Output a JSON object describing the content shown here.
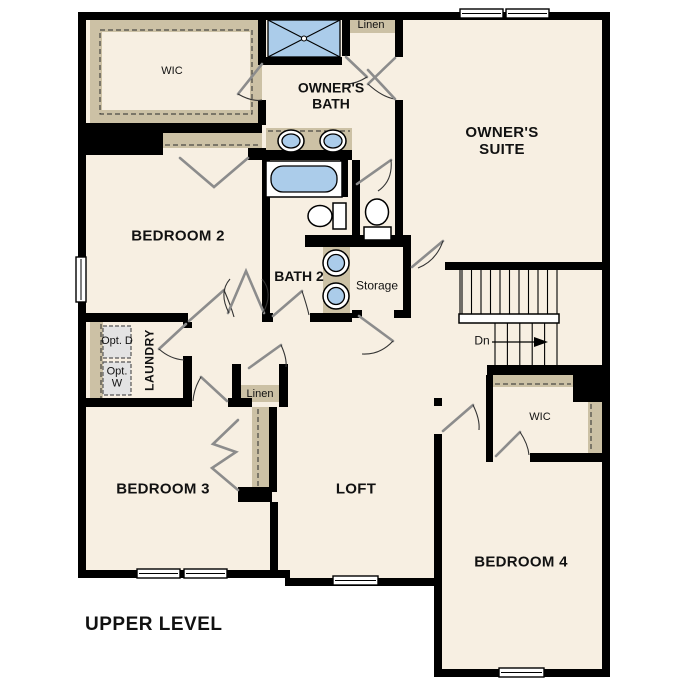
{
  "plan_title": "UPPER LEVEL",
  "labels": {
    "wic_owner": "WIC",
    "linen_owner": "Linen",
    "owners_bath": "OWNER'S BATH",
    "owners_suite": "OWNER'S SUITE",
    "bedroom2": "BEDROOM 2",
    "bath2": "BATH 2",
    "storage": "Storage",
    "stairs_dn": "Dn",
    "laundry": "LAUNDRY",
    "opt_dryer": "Opt. D",
    "opt_washer": "Opt. W",
    "linen_hall": "Linen",
    "bedroom3": "BEDROOM 3",
    "loft": "LOFT",
    "wic_bed4": "WIC",
    "bedroom4": "BEDROOM 4"
  },
  "colors": {
    "wall": "#000000",
    "floor": "#f7efe2",
    "shelf_tan": "#ccc1a5",
    "fixture_blue": "#abccea",
    "door_leaf_gray": "#8c8c8c",
    "optional_appliance_gray": "#e3e3e3",
    "background": "#ffffff",
    "label": "#111111"
  }
}
